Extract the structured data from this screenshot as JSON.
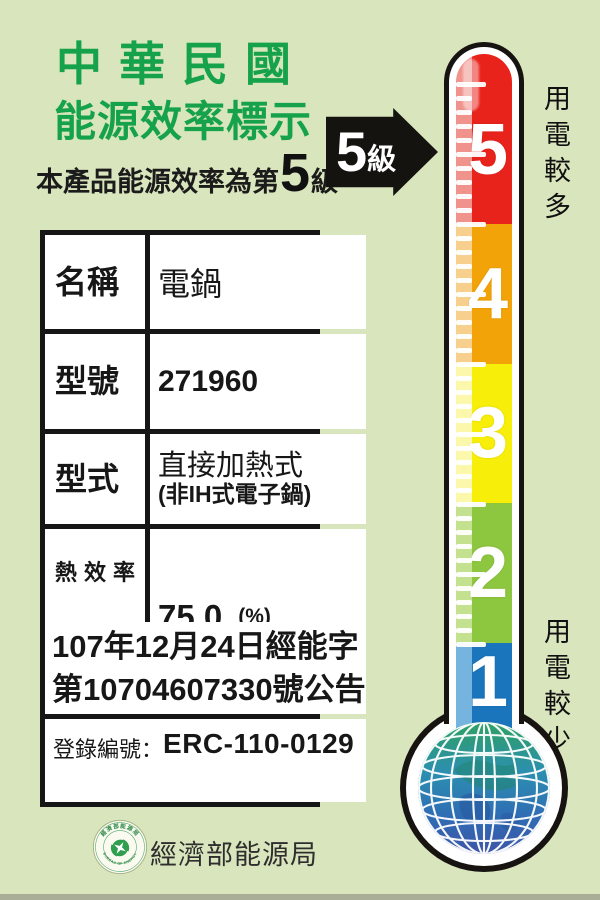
{
  "header": {
    "title_line1": "中華民國",
    "title_line2": "能源效率標示",
    "subtitle_prefix": "本產品能源效率為第",
    "subtitle_grade": "5",
    "subtitle_suffix": "級"
  },
  "arrow": {
    "grade": "5",
    "unit": "級"
  },
  "table": {
    "rows": [
      {
        "label": "名稱",
        "value": "電鍋"
      },
      {
        "label": "型號",
        "value": "271960"
      },
      {
        "label": "型式",
        "value_line1": "直接加熱式",
        "value_line2": "(非IH式電子鍋)"
      },
      {
        "label": "熱效率值",
        "value": "75.0",
        "unit": "(%)"
      }
    ],
    "announcement_line1": "107年12月24日經能字",
    "announcement_line2": "第10704607330號公告",
    "registration_label": "登錄編號：",
    "registration_value": "ERC-110-0129"
  },
  "thermometer": {
    "top_label": "用電較多",
    "bottom_label": "用電較少",
    "levels": [
      {
        "grade": "5",
        "color": "#e8231c",
        "light": "#f0938c",
        "height": 170
      },
      {
        "grade": "4",
        "color": "#f2a308",
        "light": "#f8d08d",
        "height": 140
      },
      {
        "grade": "3",
        "color": "#f7ee0a",
        "light": "#fcf8ab",
        "height": 139
      },
      {
        "grade": "2",
        "color": "#8dc63f",
        "light": "#c4e18f",
        "height": 140
      },
      {
        "grade": "1",
        "color": "#1b75bc",
        "light": "#74b4de",
        "height": 111
      }
    ]
  },
  "footer": {
    "agency": "經濟部能源局",
    "logo_ring_top": "經濟部能源局",
    "logo_ring_bottom": "BUREAU OF ENERGY"
  },
  "colors": {
    "background": "#d9e5bd",
    "title_green": "#16a24b",
    "arrow_black": "#151310",
    "table_border": "#161616",
    "globe_green": "#2ea162",
    "globe_blue": "#2f6cb4"
  }
}
